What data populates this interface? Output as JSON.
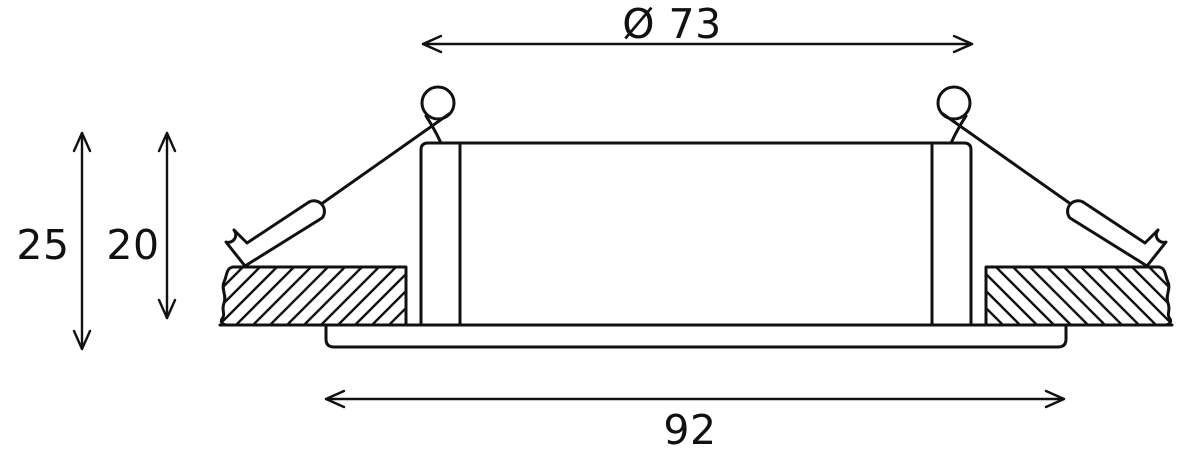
{
  "drawing": {
    "kind": "technical-dimension-drawing",
    "subject": "recessed-downlight-cross-section",
    "background_color": "#ffffff",
    "line_color": "#111111",
    "dimensions": {
      "cutout_diameter": "Ø 73",
      "overall_height": "25",
      "recess_depth": "20",
      "bezel_diameter": "92"
    }
  }
}
